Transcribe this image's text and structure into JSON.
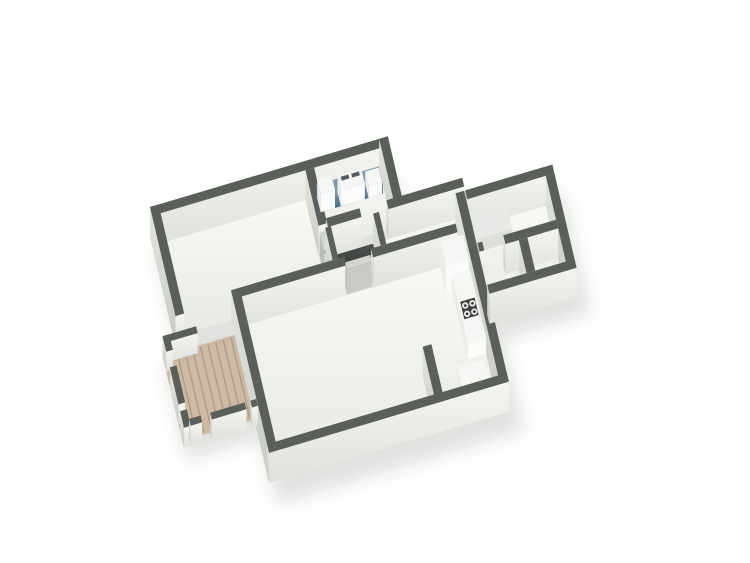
{
  "title": "3d-floor-plan-render",
  "colors": {
    "background": "#ffffff",
    "wall_top": "#5b5f59",
    "wall_face_light": "#f4f4f1",
    "wall_face_shade": "#c9c9c5",
    "floor": "#f2f2ef",
    "void_dark": "#303434",
    "deck_wood": "#cdbaa4",
    "deck_plank_line": "#a99882",
    "counter_blue_top": "#7d99ac",
    "counter_blue_side": "#507089",
    "appliance_white": "#f6f6f4",
    "appliance_side": "#ebebe7",
    "appliance_front": "#fbfbf9",
    "stove_plate": "#3f4040",
    "burner_ring": "#e8e8e6",
    "burner_center": "#2b2b2b",
    "door_leaf_top": "#d4d4d0",
    "door_leaf_front": "#c9c9c5",
    "door_leaf_side": "#bcbcb8",
    "tub_top": "#e8e8e6",
    "tub_front": "#dededb",
    "tub_side": "#cfcfcc",
    "shadow": "#d8d8d5"
  },
  "scene": {
    "type": "isometric-floorplan",
    "rooms": [
      {
        "name": "bedroom"
      },
      {
        "name": "kitchen-laundry"
      },
      {
        "name": "corridor"
      },
      {
        "name": "hallway"
      },
      {
        "name": "bathroom-suite"
      },
      {
        "name": "living-room"
      },
      {
        "name": "balcony-deck"
      }
    ],
    "features": [
      {
        "name": "blue-counter-with-appliances"
      },
      {
        "name": "washing-machine"
      },
      {
        "name": "stair-void"
      },
      {
        "name": "bathtub"
      },
      {
        "name": "refrigerator"
      },
      {
        "name": "kitchen-counter"
      },
      {
        "name": "stove-cooktop-4-burners"
      },
      {
        "name": "wood-plank-deck"
      },
      {
        "name": "deck-railing-with-gaps"
      },
      {
        "name": "interior-door-bedroom"
      },
      {
        "name": "interior-door-living-room"
      },
      {
        "name": "partition-wall"
      }
    ]
  }
}
